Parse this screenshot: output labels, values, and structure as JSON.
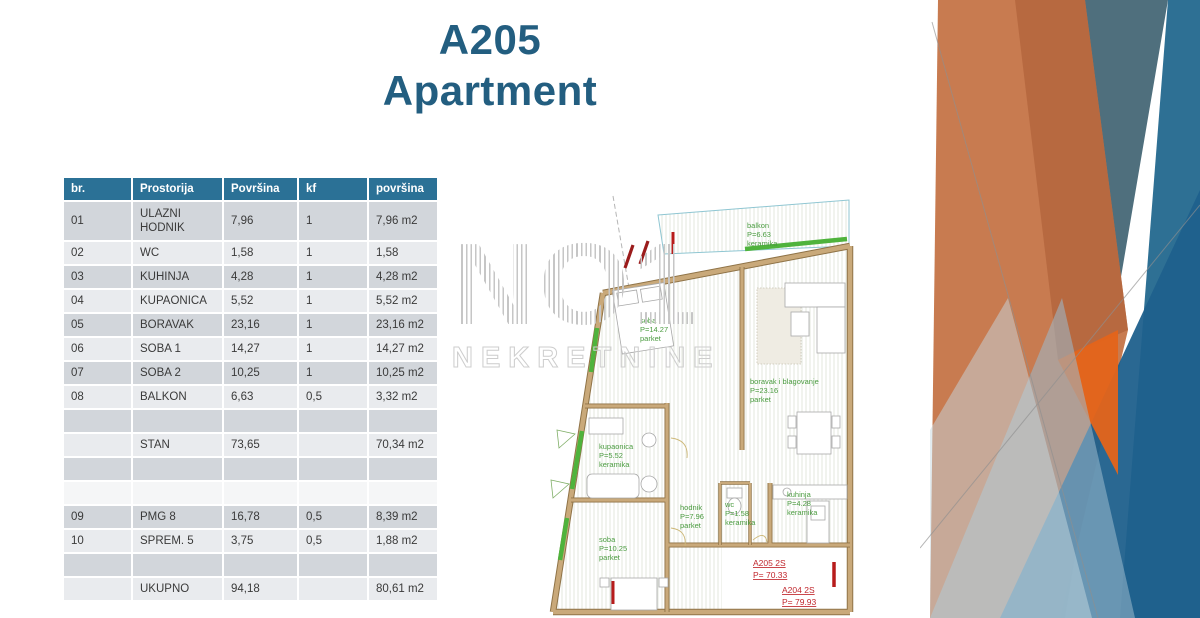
{
  "slide": {
    "title_line1": "A205",
    "title_line2": "Apartment"
  },
  "table": {
    "headers": [
      "br.",
      "Prostorija",
      "Površina",
      "kf",
      "površina"
    ],
    "rows": [
      {
        "cells": [
          "01",
          "ULAZNI HODNIK",
          "7,96",
          "1",
          "7,96 m2"
        ],
        "band": "dark",
        "tall": true
      },
      {
        "cells": [
          "02",
          "WC",
          "1,58",
          "1",
          "1,58"
        ],
        "band": "light"
      },
      {
        "cells": [
          "03",
          "KUHINJA",
          "4,28",
          "1",
          "4,28 m2"
        ],
        "band": "dark"
      },
      {
        "cells": [
          "04",
          "KUPAONICA",
          "5,52",
          "1",
          "5,52 m2"
        ],
        "band": "light"
      },
      {
        "cells": [
          "05",
          "BORAVAK",
          "23,16",
          "1",
          "23,16 m2"
        ],
        "band": "dark"
      },
      {
        "cells": [
          "06",
          "SOBA 1",
          "14,27",
          "1",
          "14,27 m2"
        ],
        "band": "light"
      },
      {
        "cells": [
          "07",
          "SOBA 2",
          "10,25",
          "1",
          "10,25 m2"
        ],
        "band": "dark"
      },
      {
        "cells": [
          "08",
          "BALKON",
          "6,63",
          "0,5",
          "3,32 m2"
        ],
        "band": "light"
      },
      {
        "cells": [
          "",
          "",
          "",
          "",
          ""
        ],
        "band": "dark"
      },
      {
        "cells": [
          "",
          "STAN",
          "73,65",
          "",
          "70,34 m2"
        ],
        "band": "light"
      },
      {
        "cells": [
          "",
          "",
          "",
          "",
          ""
        ],
        "band": "dark"
      },
      {
        "cells": [
          "",
          "",
          "",
          "",
          ""
        ],
        "band": "blank"
      },
      {
        "cells": [
          "09",
          "PMG 8",
          "16,78",
          "0,5",
          "8,39 m2"
        ],
        "band": "dark"
      },
      {
        "cells": [
          "10",
          "SPREM. 5",
          "3,75",
          "0,5",
          "1,88 m2"
        ],
        "band": "light"
      },
      {
        "cells": [
          "",
          "",
          "",
          "",
          ""
        ],
        "band": "dark"
      },
      {
        "cells": [
          "",
          "UKUPNO",
          "94,18",
          "",
          "80,61 m2"
        ],
        "band": "light"
      }
    ]
  },
  "watermark": {
    "line1": "NO1",
    "line2": "NEKRETNINE"
  },
  "floorplan": {
    "rooms": [
      {
        "id": "balkon",
        "lines": [
          "balkon",
          "P=6.63",
          "keramika"
        ],
        "x": 202,
        "y": 40
      },
      {
        "id": "soba-1",
        "lines": [
          "soba",
          "P=14.27",
          "parket"
        ],
        "x": 95,
        "y": 135
      },
      {
        "id": "boravak",
        "lines": [
          "boravak i blagovanje",
          "P=23.16",
          "parket"
        ],
        "x": 205,
        "y": 196
      },
      {
        "id": "kupaonica",
        "lines": [
          "kupaonica",
          "P=5.52",
          "keramika"
        ],
        "x": 54,
        "y": 261
      },
      {
        "id": "hodnik",
        "lines": [
          "hodnik",
          "P=7.96",
          "parket"
        ],
        "x": 135,
        "y": 322
      },
      {
        "id": "wc",
        "lines": [
          "wc",
          "P=1.58",
          "keramika"
        ],
        "x": 180,
        "y": 319
      },
      {
        "id": "kuhinja",
        "lines": [
          "kuhinja",
          "P=4.28",
          "keramika"
        ],
        "x": 242,
        "y": 309
      },
      {
        "id": "soba-2",
        "lines": [
          "soba",
          "P=10.25",
          "parket"
        ],
        "x": 54,
        "y": 354
      }
    ],
    "apartments": [
      {
        "id": "a205",
        "lines": [
          "A205   2S",
          "P=   70.33"
        ],
        "x": 208,
        "y": 378
      },
      {
        "id": "a204",
        "lines": [
          "A204   2S",
          "P=   79.93"
        ],
        "x": 237,
        "y": 405
      }
    ]
  },
  "colors": {
    "title": "#235e80",
    "table_header_bg": "#2b7196",
    "band_dark": "#d2d6db",
    "band_light": "#e9ebee",
    "wall_tan": "#c9a97a",
    "plan_green": "#4a9b3f",
    "plan_red": "#c0272d",
    "accent_orange_dark": "#bd6e47",
    "accent_orange_salmon": "#e0875c",
    "accent_orange_bright": "#e4641a",
    "accent_slate": "#4f6f7d",
    "accent_steel_blue": "#2e7094",
    "accent_dark_blue": "#1f608c",
    "accent_light_blue": "#a9c2d2"
  }
}
